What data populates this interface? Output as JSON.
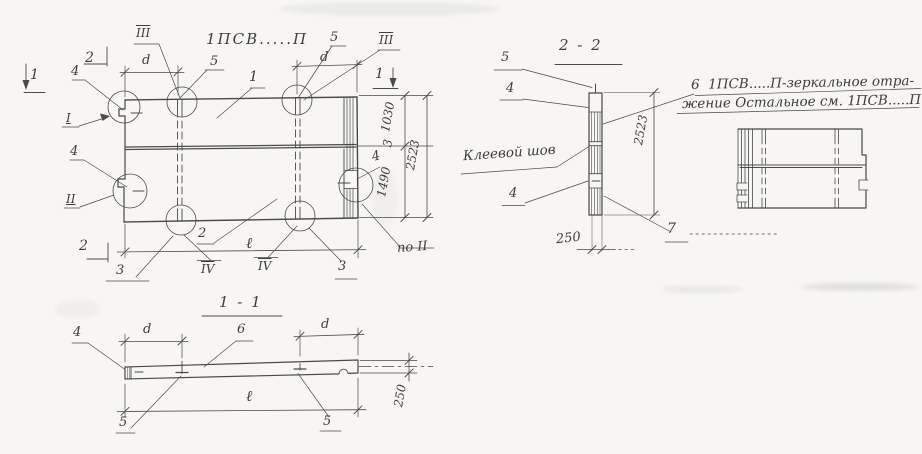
{
  "colors": {
    "ink": "#4a4a4a",
    "paper": "#f7f6f3"
  },
  "plan": {
    "title": "1ПСВ.....П",
    "marker_section1_left": "1",
    "marker_section2_top": "2",
    "marker_section1_right": "1",
    "marker_section2_bottom": "2",
    "detail_iii_left": "III",
    "detail_iii_right": "III",
    "pos_5_left": "5",
    "pos_5_right": "5",
    "dim_d_left": "d",
    "dim_d_right": "d",
    "pos_1": "1",
    "pos_4_top_left": "4",
    "detail_i": "I",
    "pos_4_mid_left": "4",
    "detail_ii": "II",
    "pos_4_right": "4",
    "pos_3_joint": "3",
    "dim_1030": "1030",
    "dim_1490": "1490",
    "dim_2523": "2523",
    "ref_po_ii": "по II",
    "pos_2": "2",
    "dim_length": "ℓ",
    "pos_3_bottom_left": "3",
    "detail_iv_left": "IV",
    "detail_iv_right": "IV",
    "pos_3_bottom_right": "3"
  },
  "section_1_1": {
    "title": "1 - 1",
    "pos_4": "4",
    "dim_d_left": "d",
    "pos_6": "6",
    "dim_d_right": "d",
    "dim_length": "ℓ",
    "pos_5_left": "5",
    "pos_5_right": "5",
    "dim_250": "250"
  },
  "section_2_2": {
    "title": "2 - 2",
    "pos_5": "5",
    "pos_4_top": "4",
    "glue_seam_label": "Клеевой шов",
    "pos_4_bottom": "4",
    "dim_2523": "2523",
    "dim_250": "250",
    "pos_7": "7",
    "note_line1": "6  1ПСВ.....П-зеркальное отра-",
    "note_line2": "жение Остальное см. 1ПСВ.....П"
  }
}
